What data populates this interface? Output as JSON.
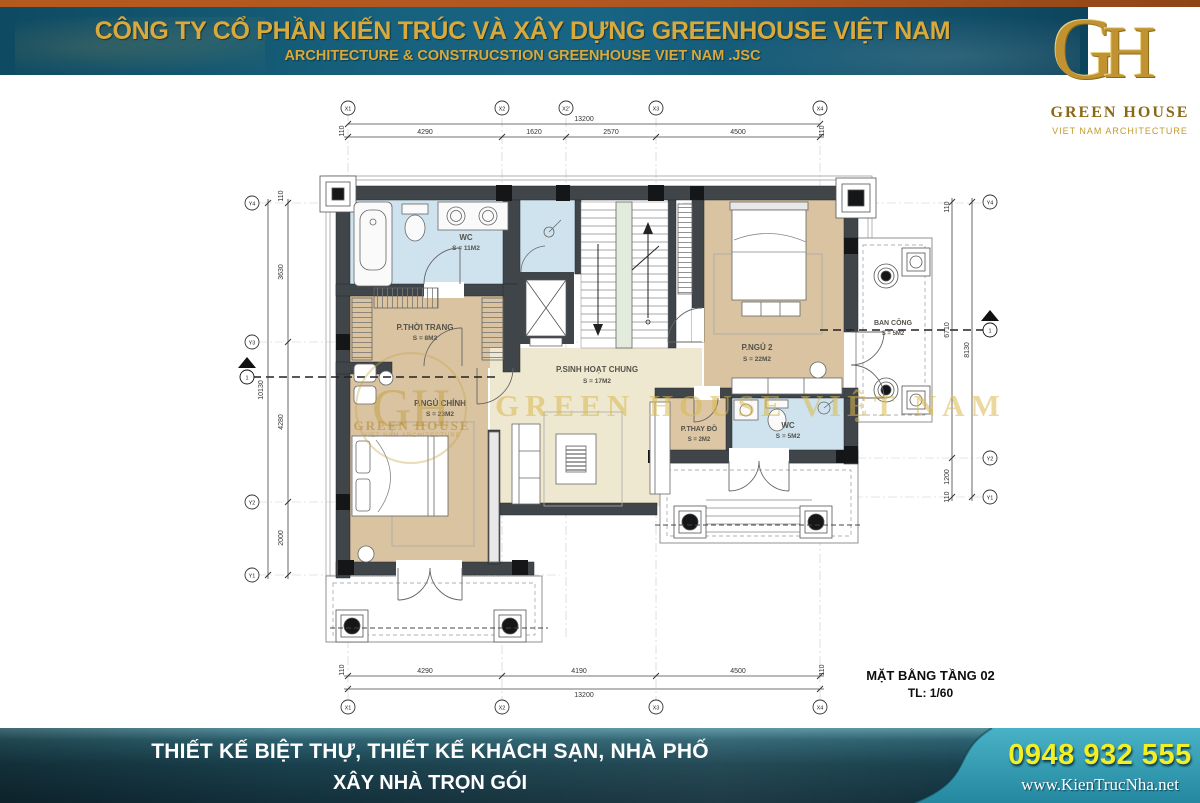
{
  "header": {
    "company_line1": "CÔNG TY CỔ PHẦN KIẾN TRÚC VÀ XÂY DỰNG GREENHOUSE VIỆT NAM",
    "company_line2": "ARCHITECTURE & CONSTRUCSTION GREENHOUSE VIET NAM .JSC",
    "colors": {
      "top_strip": "#b05620",
      "banner": "#17617d",
      "gold_text": "#d8a93c"
    },
    "logo": {
      "monogram_g": "G",
      "monogram_h": "H",
      "name": "GREEN HOUSE",
      "tagline": "VIET NAM ARCHITECTURE"
    }
  },
  "plan": {
    "title": "MẶT BẰNG TẦNG 02",
    "scale_label": "TL: 1/60",
    "rooms": [
      {
        "name": "WC",
        "area": "S = 11M2"
      },
      {
        "name": "P.THỜI TRANG",
        "area": "S = 8M2"
      },
      {
        "name": "P.SINH HOẠT CHUNG",
        "area": "S = 17M2"
      },
      {
        "name": "P.NGỦ 2",
        "area": "S = 22M2"
      },
      {
        "name": "BAN CÔNG",
        "area": "S = 5M2"
      },
      {
        "name": "P.NGỦ CHÍNH",
        "area": "S = 23M2"
      },
      {
        "name": "P.THAY ĐỒ",
        "area": "S = 2M2"
      },
      {
        "name": "WC",
        "area": "S = 5M2"
      }
    ],
    "grid_bubbles": {
      "top": [
        "X1",
        "X2",
        "X2'",
        "X3",
        "X4"
      ],
      "bottom": [
        "X1",
        "X2",
        "X3",
        "X4"
      ],
      "left": [
        "Y4",
        "Y3",
        "Y2",
        "Y1"
      ],
      "right": [
        "Y4",
        "Y2",
        "Y1"
      ]
    },
    "dimensions": {
      "top_total": "13200",
      "top_segments": [
        "4290",
        "1620",
        "2570",
        "4500"
      ],
      "top_edge_left": "110",
      "top_edge_right": "110",
      "bottom_total": "13200",
      "bottom_segments": [
        "4290",
        "4190",
        "4500"
      ],
      "bottom_edge_left": "110",
      "bottom_edge_right": "110",
      "left_total": "10130",
      "left_segments": [
        "3630",
        "4280",
        "2000"
      ],
      "left_edge_top": "110",
      "right_total": "8130",
      "right_segments": [
        "110",
        "6710",
        "1200",
        "110"
      ]
    },
    "section_marker_label": "1"
  },
  "watermark": {
    "text": "GREEN HOUSE VIỆT NAM",
    "logo_monogram": "GH",
    "logo_name": "GREEN HOUSE",
    "logo_tagline": "VIET NAM ARCHITECTURE"
  },
  "footer": {
    "services_line1": "THIẾT KẾ BIỆT THỰ, THIẾT KẾ KHÁCH SẠN, NHÀ PHỐ",
    "services_line2": "XÂY NHÀ TRỌN GÓI",
    "phone": "0948 932 555",
    "website": "www.KienTrucNha.net",
    "colors": {
      "phone": "#f3ef25",
      "right_panel": "#35a2b8"
    }
  }
}
